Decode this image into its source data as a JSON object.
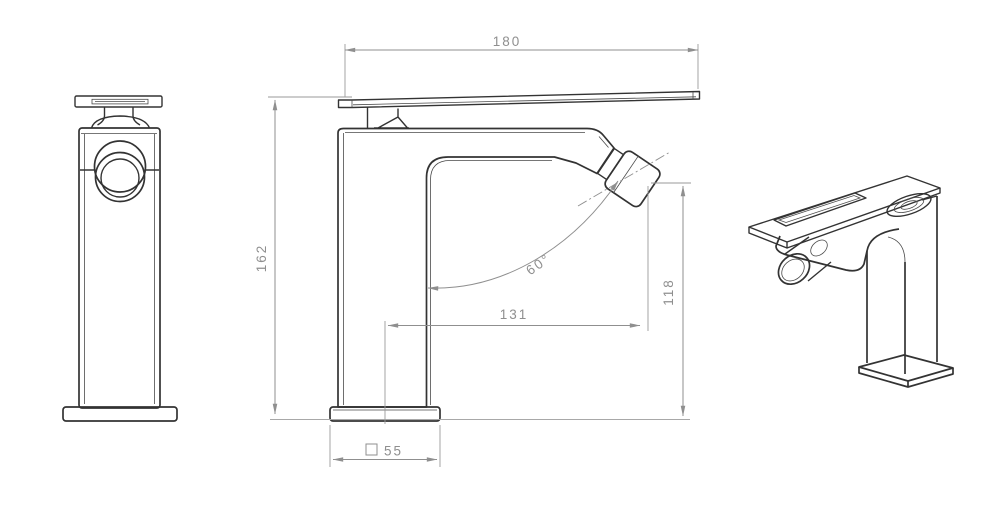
{
  "drawing": {
    "type": "technical-orthographic-drawing",
    "subject": "single-lever bidet mixer faucet",
    "views": [
      "front-view",
      "side-view",
      "perspective-view"
    ],
    "dimensions": {
      "handle_length": "180",
      "overall_height": "162",
      "aerator_height": "118",
      "spout_reach": "131",
      "aerator_angle": "60°",
      "base_width": "55"
    },
    "colors": {
      "object_line": "#333333",
      "dimension_line": "#8f8f8f",
      "surface_line": "#a8a8a8",
      "background": "#ffffff"
    }
  }
}
